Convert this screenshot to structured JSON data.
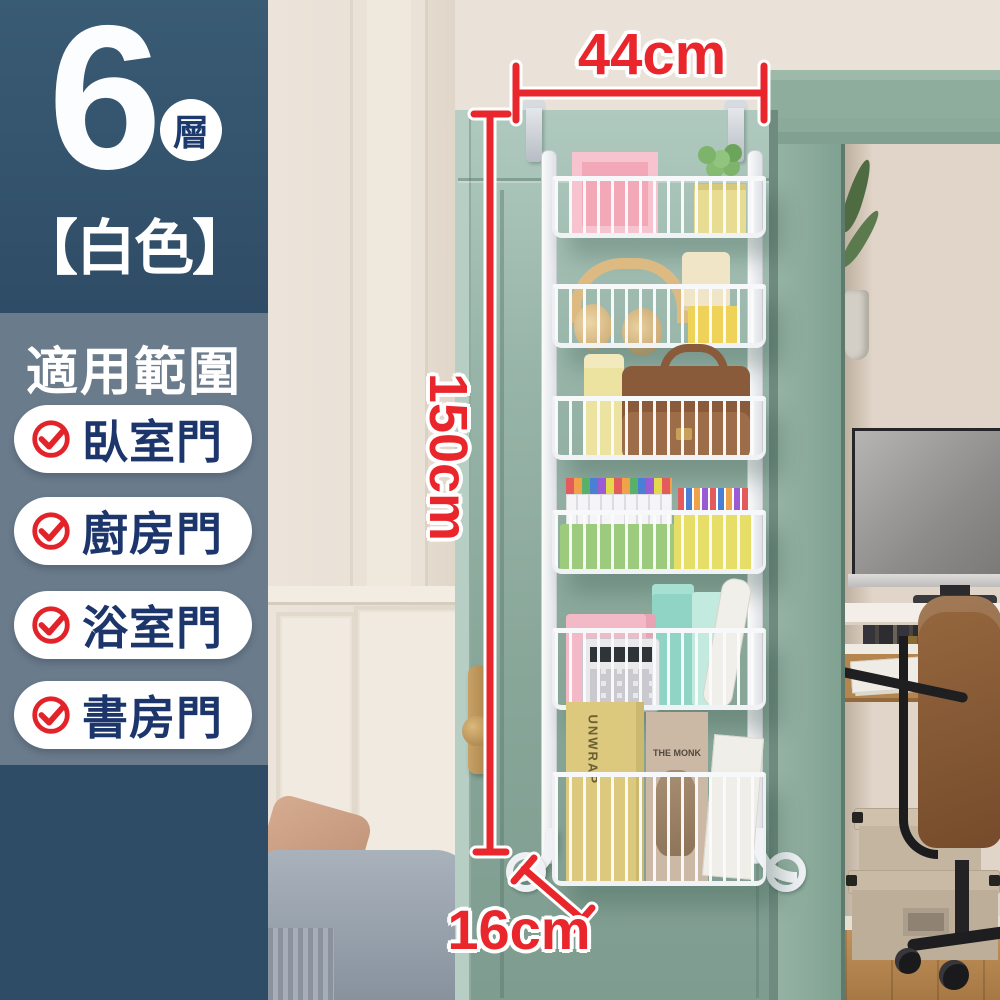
{
  "sidebar": {
    "tier_count": "6",
    "tier_unit": "層",
    "color_variant": "【白色】",
    "section_title": "適用範圍",
    "applicable_items": [
      {
        "label": "臥室門"
      },
      {
        "label": "廚房門"
      },
      {
        "label": "浴室門"
      },
      {
        "label": "書房門"
      }
    ]
  },
  "annotations": {
    "width": "44cm",
    "height": "150cm",
    "depth": "16cm"
  },
  "scene": {
    "book_spine": "UNWRAP",
    "magazine_title": "THE MONK"
  },
  "colors": {
    "banner_dark_blue": "#2F4C66",
    "panel_slate_blue": "#6A7B8C",
    "pill_text_navy": "#1C356B",
    "check_red": "#E2242A",
    "dimension_red": "#E8262B",
    "door_green": "#8FAE9F",
    "rack_white": "#F4F5F7"
  }
}
